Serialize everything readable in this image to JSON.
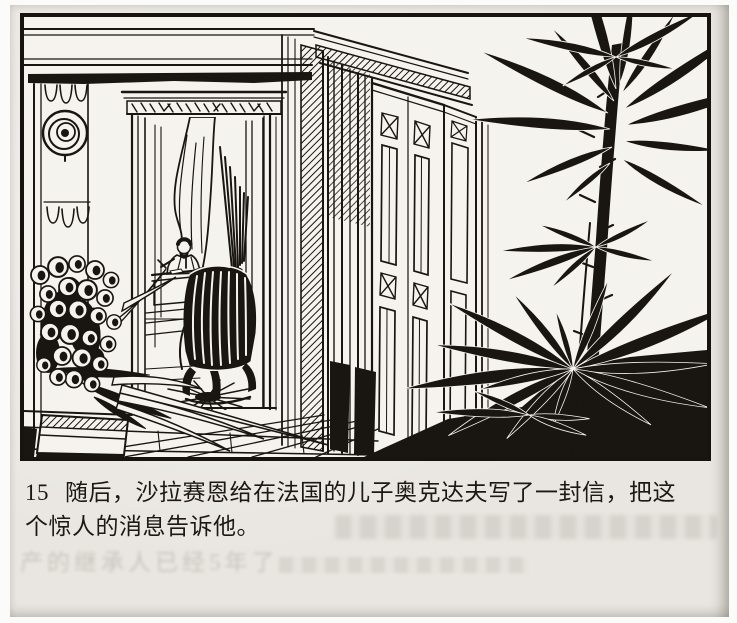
{
  "panel": {
    "number": "15",
    "description": "Black-and-white ink line-art interior: ornate cornice and pilaster with round rosette at left; curtained doorway through which a bearded man writes at a desk behind a tall ribbed armchair on a sunburst rug; open folding paneled doors in the center; a large dark potted palm fills the right foreground over a black shadow band; a bouquet of round flowers on a pedestal at lower left; tiled floor.",
    "elements": [
      "cornice",
      "wall-pilaster",
      "rosette-ornament",
      "doorway-with-curtain",
      "man-writing-at-desk",
      "desk",
      "ribbed-armchair",
      "sunburst-rug",
      "folding-paneled-doors",
      "palm-plant",
      "flower-bouquet",
      "pedestal",
      "tiled-floor",
      "shadow-band"
    ]
  },
  "caption": {
    "number": "15",
    "line1": "随后，沙拉赛恩给在法国的儿子奥克达夫写了一封信，把这",
    "line2": "个惊人的消息告诉他。",
    "full_text": "15 随后，沙拉赛恩给在法国的儿子奥克达夫写了一封信，把这个惊人的消息告诉他。"
  },
  "bleedthrough": {
    "visible_fragment": "产的继承人已经5年了"
  },
  "colors": {
    "paper": "#e9e6e1",
    "panel_background": "#f5f3ee",
    "ink": "#191510",
    "caption_text": "#1c1813"
  }
}
